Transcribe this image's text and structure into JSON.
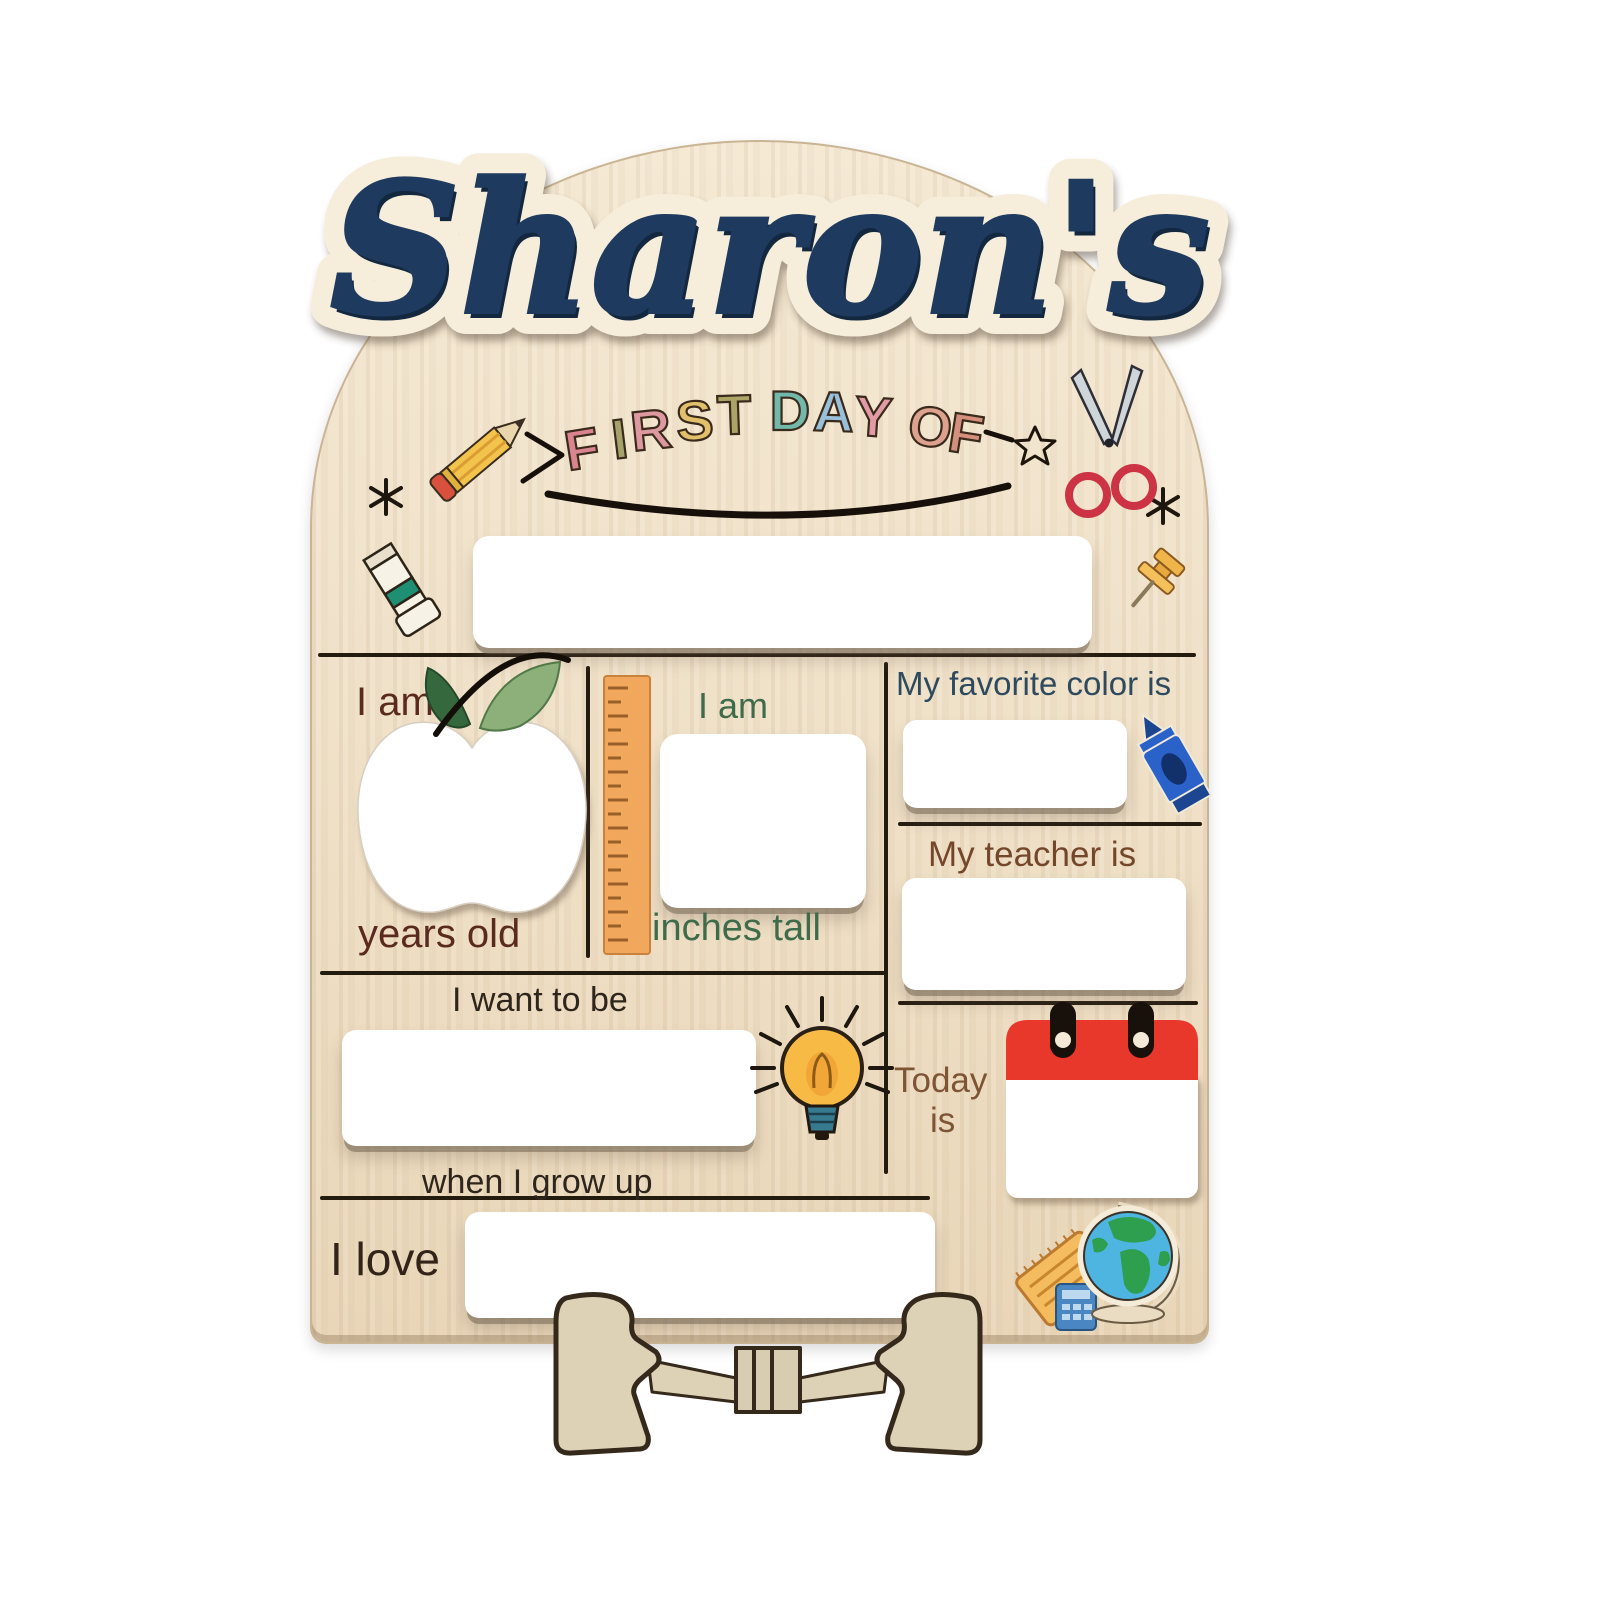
{
  "product": {
    "name": "Sharon's",
    "banner": {
      "text": "FIRST DAY OF",
      "letters": [
        {
          "ch": "F",
          "color": "#d9848e"
        },
        {
          "ch": "I",
          "color": "#a6a26b"
        },
        {
          "ch": "R",
          "color": "#dd98a0"
        },
        {
          "ch": "S",
          "color": "#e2c06b"
        },
        {
          "ch": "T",
          "color": "#aaa566"
        },
        {
          "ch": "D",
          "color": "#72b8ab"
        },
        {
          "ch": "A",
          "color": "#99c0da"
        },
        {
          "ch": "Y",
          "color": "#e29aa4"
        },
        {
          "ch": "O",
          "color": "#dda18f"
        },
        {
          "ch": "F",
          "color": "#d58f7d"
        }
      ]
    },
    "labels": {
      "age_prefix": "I am",
      "age_suffix": "years old",
      "height_prefix": "I am",
      "height_suffix": "inches tall",
      "favorite_color": "My favorite color is",
      "teacher": "My teacher is",
      "grow_up_prefix": "I want to be",
      "grow_up_suffix": "when I grow up",
      "today_line1": "Today",
      "today_line2": "is",
      "love": "I love"
    },
    "fields": {
      "school": "",
      "age": "",
      "height": "",
      "favorite_color": "",
      "teacher": "",
      "grow_up": "",
      "today": "",
      "love": ""
    },
    "colors": {
      "wood": "#efe0c7",
      "name_navy": "#1e3a5f",
      "divider": "#241b0f",
      "age_maroon": "#5a2a1e",
      "height_green": "#3e6b4a",
      "favorite_slate": "#2e4a5e",
      "teacher_brown": "#74462a",
      "grow_up_dark": "#2e261c",
      "today_brown": "#7d5434",
      "love_brown": "#33241a",
      "ruler_orange": "#f2a85c",
      "calendar_red": "#e8382c",
      "crayon_blue": "#2b62c9",
      "bulb_yellow": "#f7bb45",
      "globe_blue": "#4db5e0",
      "easel_tan": "#ddd2b5"
    },
    "icons": [
      "pencil",
      "scissors",
      "sparkle",
      "star",
      "glue-stick",
      "pushpin",
      "apple",
      "ruler",
      "crayon",
      "lightbulb",
      "calendar",
      "globe",
      "notepad",
      "calculator",
      "easel-stand"
    ]
  }
}
